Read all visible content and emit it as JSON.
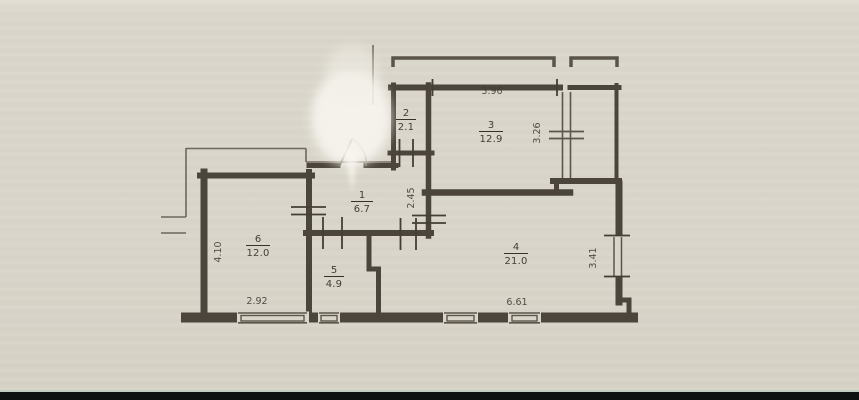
{
  "plan": {
    "rooms": [
      {
        "number": "1",
        "area": "6.7"
      },
      {
        "number": "2",
        "area": "2.1"
      },
      {
        "number": "3",
        "area": "12.9"
      },
      {
        "number": "4",
        "area": "21.0"
      },
      {
        "number": "5",
        "area": "4.9"
      },
      {
        "number": "6",
        "area": "12.0"
      }
    ],
    "dimensions": {
      "room3_width": "3.96",
      "room3_depth": "3.26",
      "hall_depth": "2.45",
      "room6_depth": "4.10",
      "room6_width": "2.92",
      "room4_width": "6.61",
      "room4_depth": "3.41"
    },
    "colors": {
      "paper": "#d9d5ca",
      "wall": "#4b453b",
      "thin_line": "#6e675b",
      "text": "#36312a",
      "watermark": "#f8f6f0",
      "bottom_bar": "#0e0f11"
    }
  }
}
